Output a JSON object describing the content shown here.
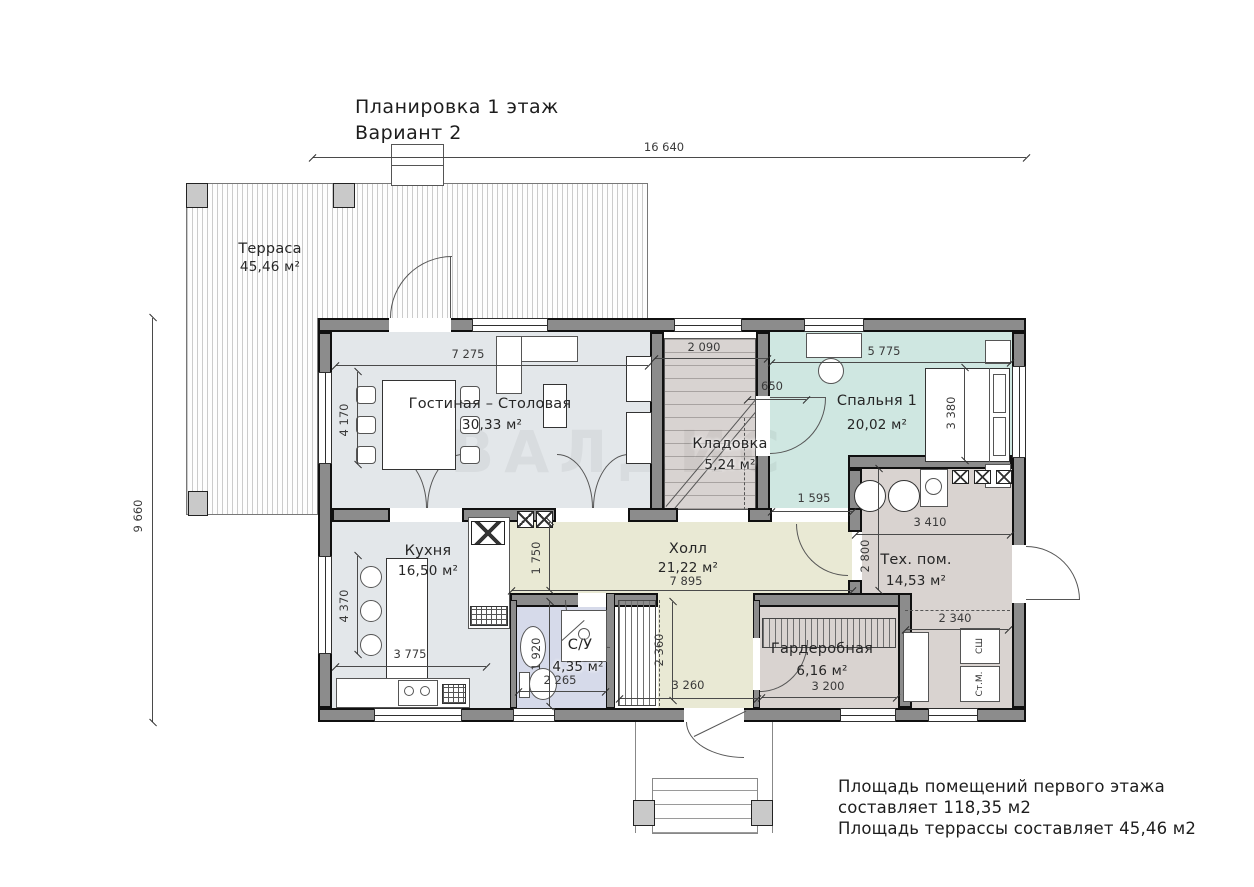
{
  "title": {
    "line1": "Планировка 1 этаж",
    "line2": "Вариант 2"
  },
  "watermark": "ВАЛДИС",
  "rooms": {
    "terrace": {
      "name": "Терраса",
      "area": "45,46 м²"
    },
    "living": {
      "name": "Гостиная – Столовая",
      "area": "30,33 м²"
    },
    "bedroom": {
      "name": "Спальня 1",
      "area": "20,02 м²"
    },
    "closet": {
      "name": "Кладовка",
      "area": "5,24 м²"
    },
    "kitchen": {
      "name": "Кухня",
      "area": "16,50 м²"
    },
    "hall": {
      "name": "Холл",
      "area": "21,22 м²"
    },
    "tech": {
      "name": "Тех. пом.",
      "area": "14,53 м²"
    },
    "bath": {
      "name": "С/У",
      "area": "4,35 м²"
    },
    "wardrobe": {
      "name": "Гардеробная",
      "area": "6,16 м²"
    }
  },
  "dims": {
    "w_total": "16 640",
    "h_total": "9 660",
    "living_w": "7 275",
    "stair_w": "2 090",
    "stair_off": "650",
    "bedroom_w": "5 775",
    "bedroom_h": "3 380",
    "win_living": "4 170",
    "win_kitchen": "4 370",
    "bed_exit": "1 595",
    "tech_w": "3 410",
    "tech_h": "2 800",
    "hall_d": "1 750",
    "hall_w": "7 895",
    "kitchen_w": "3 775",
    "bath_h": "1 920",
    "bath_w": "2 265",
    "entry_h": "2 360",
    "entry_w": "3 260",
    "wardrobe_w": "3 200",
    "laundry_w": "2 340"
  },
  "appliances": {
    "dryer": "СШ",
    "washer": "Ст.М."
  },
  "summary": {
    "line1": "Площадь помещений первого этажа",
    "line2": "составляет 118,35 м2",
    "line3": "Площадь террассы составляет 45,46 м2"
  },
  "palette": {
    "wall": "#8c8c8c",
    "living": "#e3e7ea",
    "bedroom": "#cfe7e1",
    "hall": "#e9e9d4",
    "service": "#d9d3d0",
    "bath": "#d6daea"
  }
}
